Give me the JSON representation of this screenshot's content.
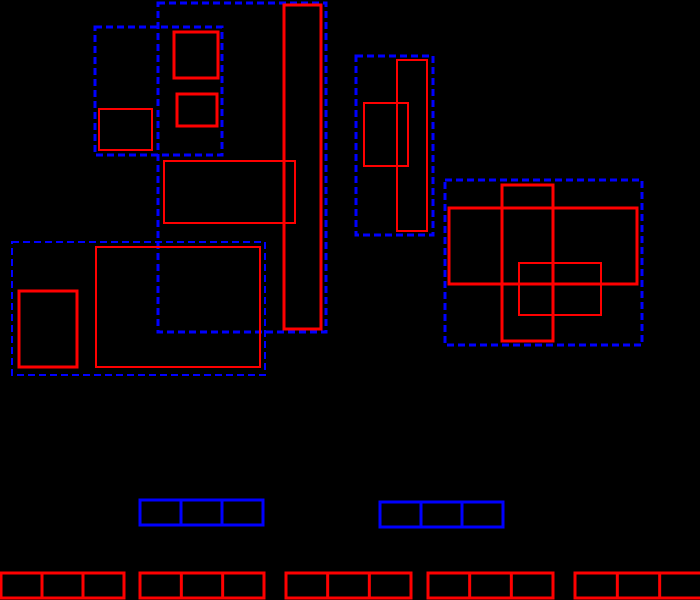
{
  "canvas": {
    "width": 700,
    "height": 600,
    "background": "#000000"
  },
  "palette": {
    "red": "#ff0000",
    "blue": "#0000ff",
    "background": "#000000"
  },
  "shapes": {
    "blue_dashed_boxes": [
      {
        "x": 95,
        "y": 27,
        "w": 127,
        "h": 128,
        "stroke": 3,
        "dash": "7 4"
      },
      {
        "x": 158,
        "y": 3,
        "w": 168,
        "h": 329,
        "stroke": 3,
        "dash": "7 4"
      },
      {
        "x": 12,
        "y": 242,
        "w": 253,
        "h": 133,
        "stroke": 2,
        "dash": "7 4"
      },
      {
        "x": 356,
        "y": 56,
        "w": 77,
        "h": 179,
        "stroke": 3,
        "dash": "7 4"
      },
      {
        "x": 445,
        "y": 180,
        "w": 197,
        "h": 165,
        "stroke": 3,
        "dash": "7 4"
      }
    ],
    "red_solid_boxes": [
      {
        "x": 174,
        "y": 32,
        "w": 44,
        "h": 46,
        "stroke": 3
      },
      {
        "x": 177,
        "y": 94,
        "w": 40,
        "h": 32,
        "stroke": 3
      },
      {
        "x": 99,
        "y": 109,
        "w": 53,
        "h": 41,
        "stroke": 2
      },
      {
        "x": 284,
        "y": 5,
        "w": 37,
        "h": 324,
        "stroke": 3
      },
      {
        "x": 164,
        "y": 161,
        "w": 131,
        "h": 62,
        "stroke": 2
      },
      {
        "x": 19,
        "y": 291,
        "w": 58,
        "h": 76,
        "stroke": 3
      },
      {
        "x": 96,
        "y": 247,
        "w": 164,
        "h": 120,
        "stroke": 2
      },
      {
        "x": 397,
        "y": 60,
        "w": 30,
        "h": 171,
        "stroke": 2
      },
      {
        "x": 364,
        "y": 103,
        "w": 44,
        "h": 63,
        "stroke": 2
      },
      {
        "x": 449,
        "y": 208,
        "w": 188,
        "h": 76,
        "stroke": 3
      },
      {
        "x": 502,
        "y": 185,
        "w": 51,
        "h": 156,
        "stroke": 3
      },
      {
        "x": 519,
        "y": 263,
        "w": 82,
        "h": 52,
        "stroke": 2
      }
    ],
    "blue_segmented_bars": [
      {
        "x": 140,
        "y": 500,
        "w": 123,
        "h": 25,
        "segments": 3,
        "stroke": 3
      },
      {
        "x": 380,
        "y": 502,
        "w": 123,
        "h": 25,
        "segments": 3,
        "stroke": 3
      }
    ],
    "red_segmented_bars": [
      {
        "x": 1,
        "y": 573,
        "w": 123,
        "h": 25,
        "segments": 3,
        "stroke": 3
      },
      {
        "x": 140,
        "y": 573,
        "w": 124,
        "h": 25,
        "segments": 3,
        "stroke": 3
      },
      {
        "x": 286,
        "y": 573,
        "w": 125,
        "h": 25,
        "segments": 3,
        "stroke": 3
      },
      {
        "x": 428,
        "y": 573,
        "w": 125,
        "h": 25,
        "segments": 3,
        "stroke": 3
      },
      {
        "x": 575,
        "y": 573,
        "w": 127,
        "h": 25,
        "segments": 3,
        "stroke": 3
      }
    ]
  }
}
